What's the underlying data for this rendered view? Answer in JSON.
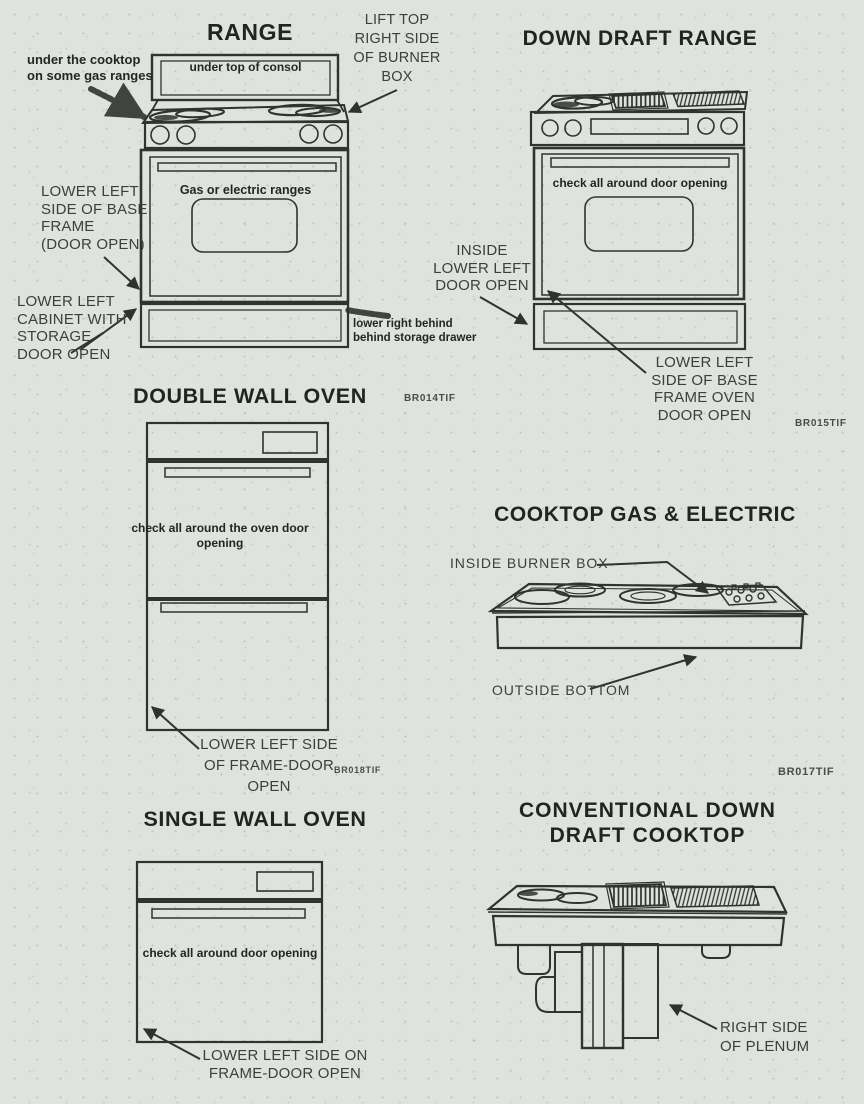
{
  "page": {
    "paper_color": "#e0e2dd",
    "ink_color": "#30332e"
  },
  "figure_codes": {
    "br014": "BR014TIF",
    "br015": "BR015TIF",
    "br017": "BR017TIF",
    "br018": "BR018TIF"
  },
  "sections": {
    "range": {
      "title": "RANGE",
      "labels": {
        "lift_top": "LIFT TOP\nRIGHT SIDE\nOF BURNER\nBOX",
        "under_cooktop": "under the cooktop\non some gas ranges",
        "under_console": "under top of consol",
        "oven_text": "Gas or electric ranges",
        "lower_left_base": "LOWER LEFT\nSIDE OF BASE\nFRAME\n(DOOR OPEN)",
        "lower_left_cabinet": "LOWER LEFT\nCABINET WITH\nSTORAGE\nDOOR OPEN",
        "lower_right_behind": "lower right behind\nbehind storage drawer"
      }
    },
    "down_draft_range": {
      "title": "DOWN DRAFT RANGE",
      "labels": {
        "door_text": "check all around door opening",
        "inside_lower_left": "INSIDE\nLOWER LEFT\nDOOR OPEN",
        "lower_left_base": "LOWER LEFT\nSIDE OF BASE\nFRAME OVEN\nDOOR OPEN"
      }
    },
    "double_wall_oven": {
      "title": "DOUBLE WALL OVEN",
      "labels": {
        "door_text": "check all around the oven door opening",
        "lower_left_frame": "LOWER LEFT SIDE\nOF FRAME-DOOR\nOPEN"
      }
    },
    "cooktop_gas_electric": {
      "title": "COOKTOP GAS & ELECTRIC",
      "labels": {
        "inside_burner_box": "INSIDE BURNER BOX",
        "outside_bottom": "OUTSIDE BOTTOM"
      }
    },
    "single_wall_oven": {
      "title": "SINGLE WALL OVEN",
      "labels": {
        "door_text": "check all around door opening",
        "lower_left_frame": "LOWER LEFT SIDE ON\nFRAME-DOOR OPEN"
      }
    },
    "conventional_downdraft": {
      "title": "CONVENTIONAL DOWN\nDRAFT COOKTOP",
      "labels": {
        "right_side_plenum": "RIGHT SIDE\nOF PLENUM"
      }
    }
  }
}
